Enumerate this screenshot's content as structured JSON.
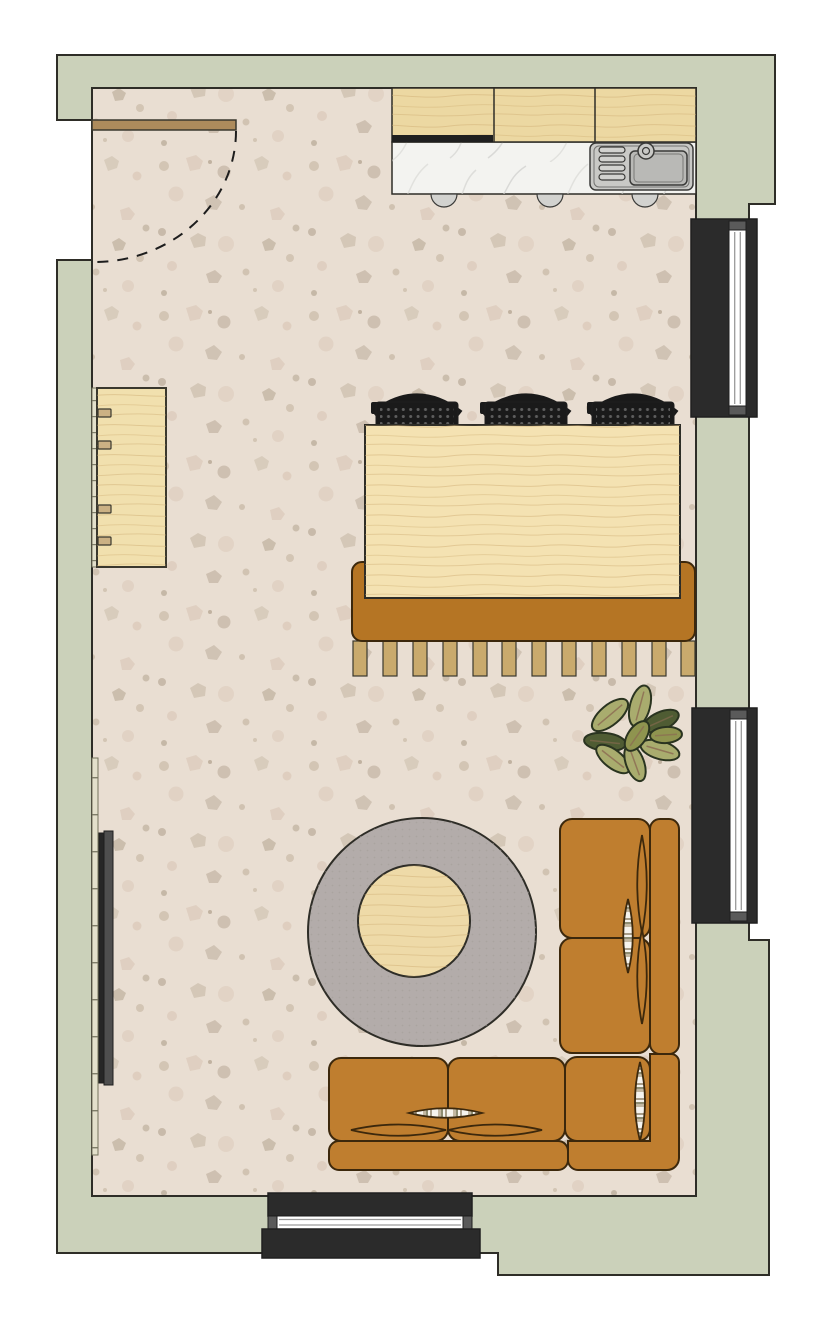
{
  "scene": {
    "type": "floor-plan",
    "view": "top-down",
    "description": "Open-plan living room and kitchen floor plan with terrazzo floor"
  },
  "inventory": {
    "entry_door": "hinged entry door with dashed swing arc (top-left)",
    "kitchen_run": "kitchen cabinets with hood strip, marble counter, stainless sink, 3 door pulls",
    "sideboard": "light wood sideboard with four handles (left wall)",
    "wall_trim": "two tick-marked wall ledge segments on left wall",
    "tv": "wall-mounted television (left wall)",
    "dining_rug": "caramel rectangular rug with 12 fringe tassels",
    "dining_table": "rectangular light-wood dining table",
    "dining_chairs": "three black perforated-seat chairs with curved backs",
    "plant": "leafy potted plant seen from above",
    "round_rug": "round grey area rug",
    "coffee_table": "round wooden coffee table",
    "sofa": "caramel L-shaped sectional sofa with bolster cushions and striped pillows",
    "window_right_top": "window in right wall (upper)",
    "window_right_bottom": "window in right wall (lower)",
    "window_bottom": "window in bottom wall"
  },
  "counts": {
    "dining_chairs": 3,
    "windows": 3,
    "fringe_tassels": 12,
    "sofa_seat_cushions": 5,
    "sideboard_handles": 4,
    "plant_leaves": 9
  },
  "colors": {
    "page": "#ffffff",
    "outline": "#2e2d27",
    "wall": "#cbd1ba",
    "floor": "#e9ded2",
    "speck1": "#cdbfad",
    "speck2": "#dccaba",
    "speck3": "#b7a895",
    "wood_cabinet": "#ecd8a2",
    "wood_table": "#f4e2b2",
    "wood_side": "#f1e0ae",
    "wood_coffee": "#eedaa8",
    "wood_line": "#3a382e",
    "grain": "#cfae74",
    "marble": "#f3f3f0",
    "marble_vein": "#cfcfcc",
    "hood": "#1f1f1f",
    "steel": "#c9c9c6",
    "steel_mid": "#b9b9b6",
    "steel_line": "#3a3a38",
    "handle": "#d2d2cf",
    "door_leaf": "#ad8b5c",
    "swing": "#1d1d1d",
    "trim": "#e3e0cb",
    "trim_line": "#75745e",
    "side_handle": "#cbb184",
    "tv_back": "#262626",
    "tv_front": "#4e4e4e",
    "rug_dining": "#b57524",
    "fringe": "#c9aa6d",
    "rug_round": "#b3acaa",
    "rug_round_dot": "#a19a96",
    "chair": "#1a1a1a",
    "chair_dot": "#5e5e5e",
    "sofa": "#bf7e2f",
    "sofa_line": "#3c280c",
    "stripe_white": "#f6f4ee",
    "stripe_tan": "#c3b8a2",
    "stripe_olive": "#8e8d72",
    "stripe_taupe": "#a89d88",
    "plant_light": "#a9ac6e",
    "plant_mid": "#8f944f",
    "plant_dark": "#4f5c33",
    "plant_line": "#2a3420",
    "plant_vein": "#8c6b52",
    "win_frame": "#2b2b2b",
    "win_glass": "#ffffff",
    "win_line": "#9a9a9a",
    "win_cap": "#5a5a5a"
  }
}
